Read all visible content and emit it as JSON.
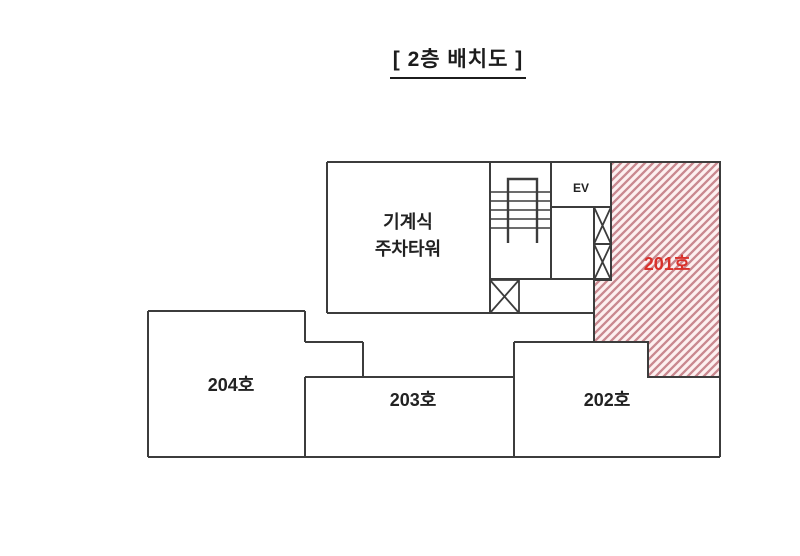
{
  "title": "[ 2층 배치도 ]",
  "colors": {
    "wall": "#3c3c3c",
    "hatch_stripe": "#c9888f",
    "hatch_background": "#fdf0f0",
    "highlight_text": "#d9312b",
    "label_text": "#222222",
    "background": "#ffffff"
  },
  "rooms": {
    "parking": {
      "label_line1": "기계식",
      "label_line2": "주차타워"
    },
    "elevator": {
      "label": "EV"
    },
    "room201": {
      "label": "201호",
      "highlighted": true
    },
    "room202": {
      "label": "202호"
    },
    "room203": {
      "label": "203호"
    },
    "room204": {
      "label": "204호"
    }
  }
}
